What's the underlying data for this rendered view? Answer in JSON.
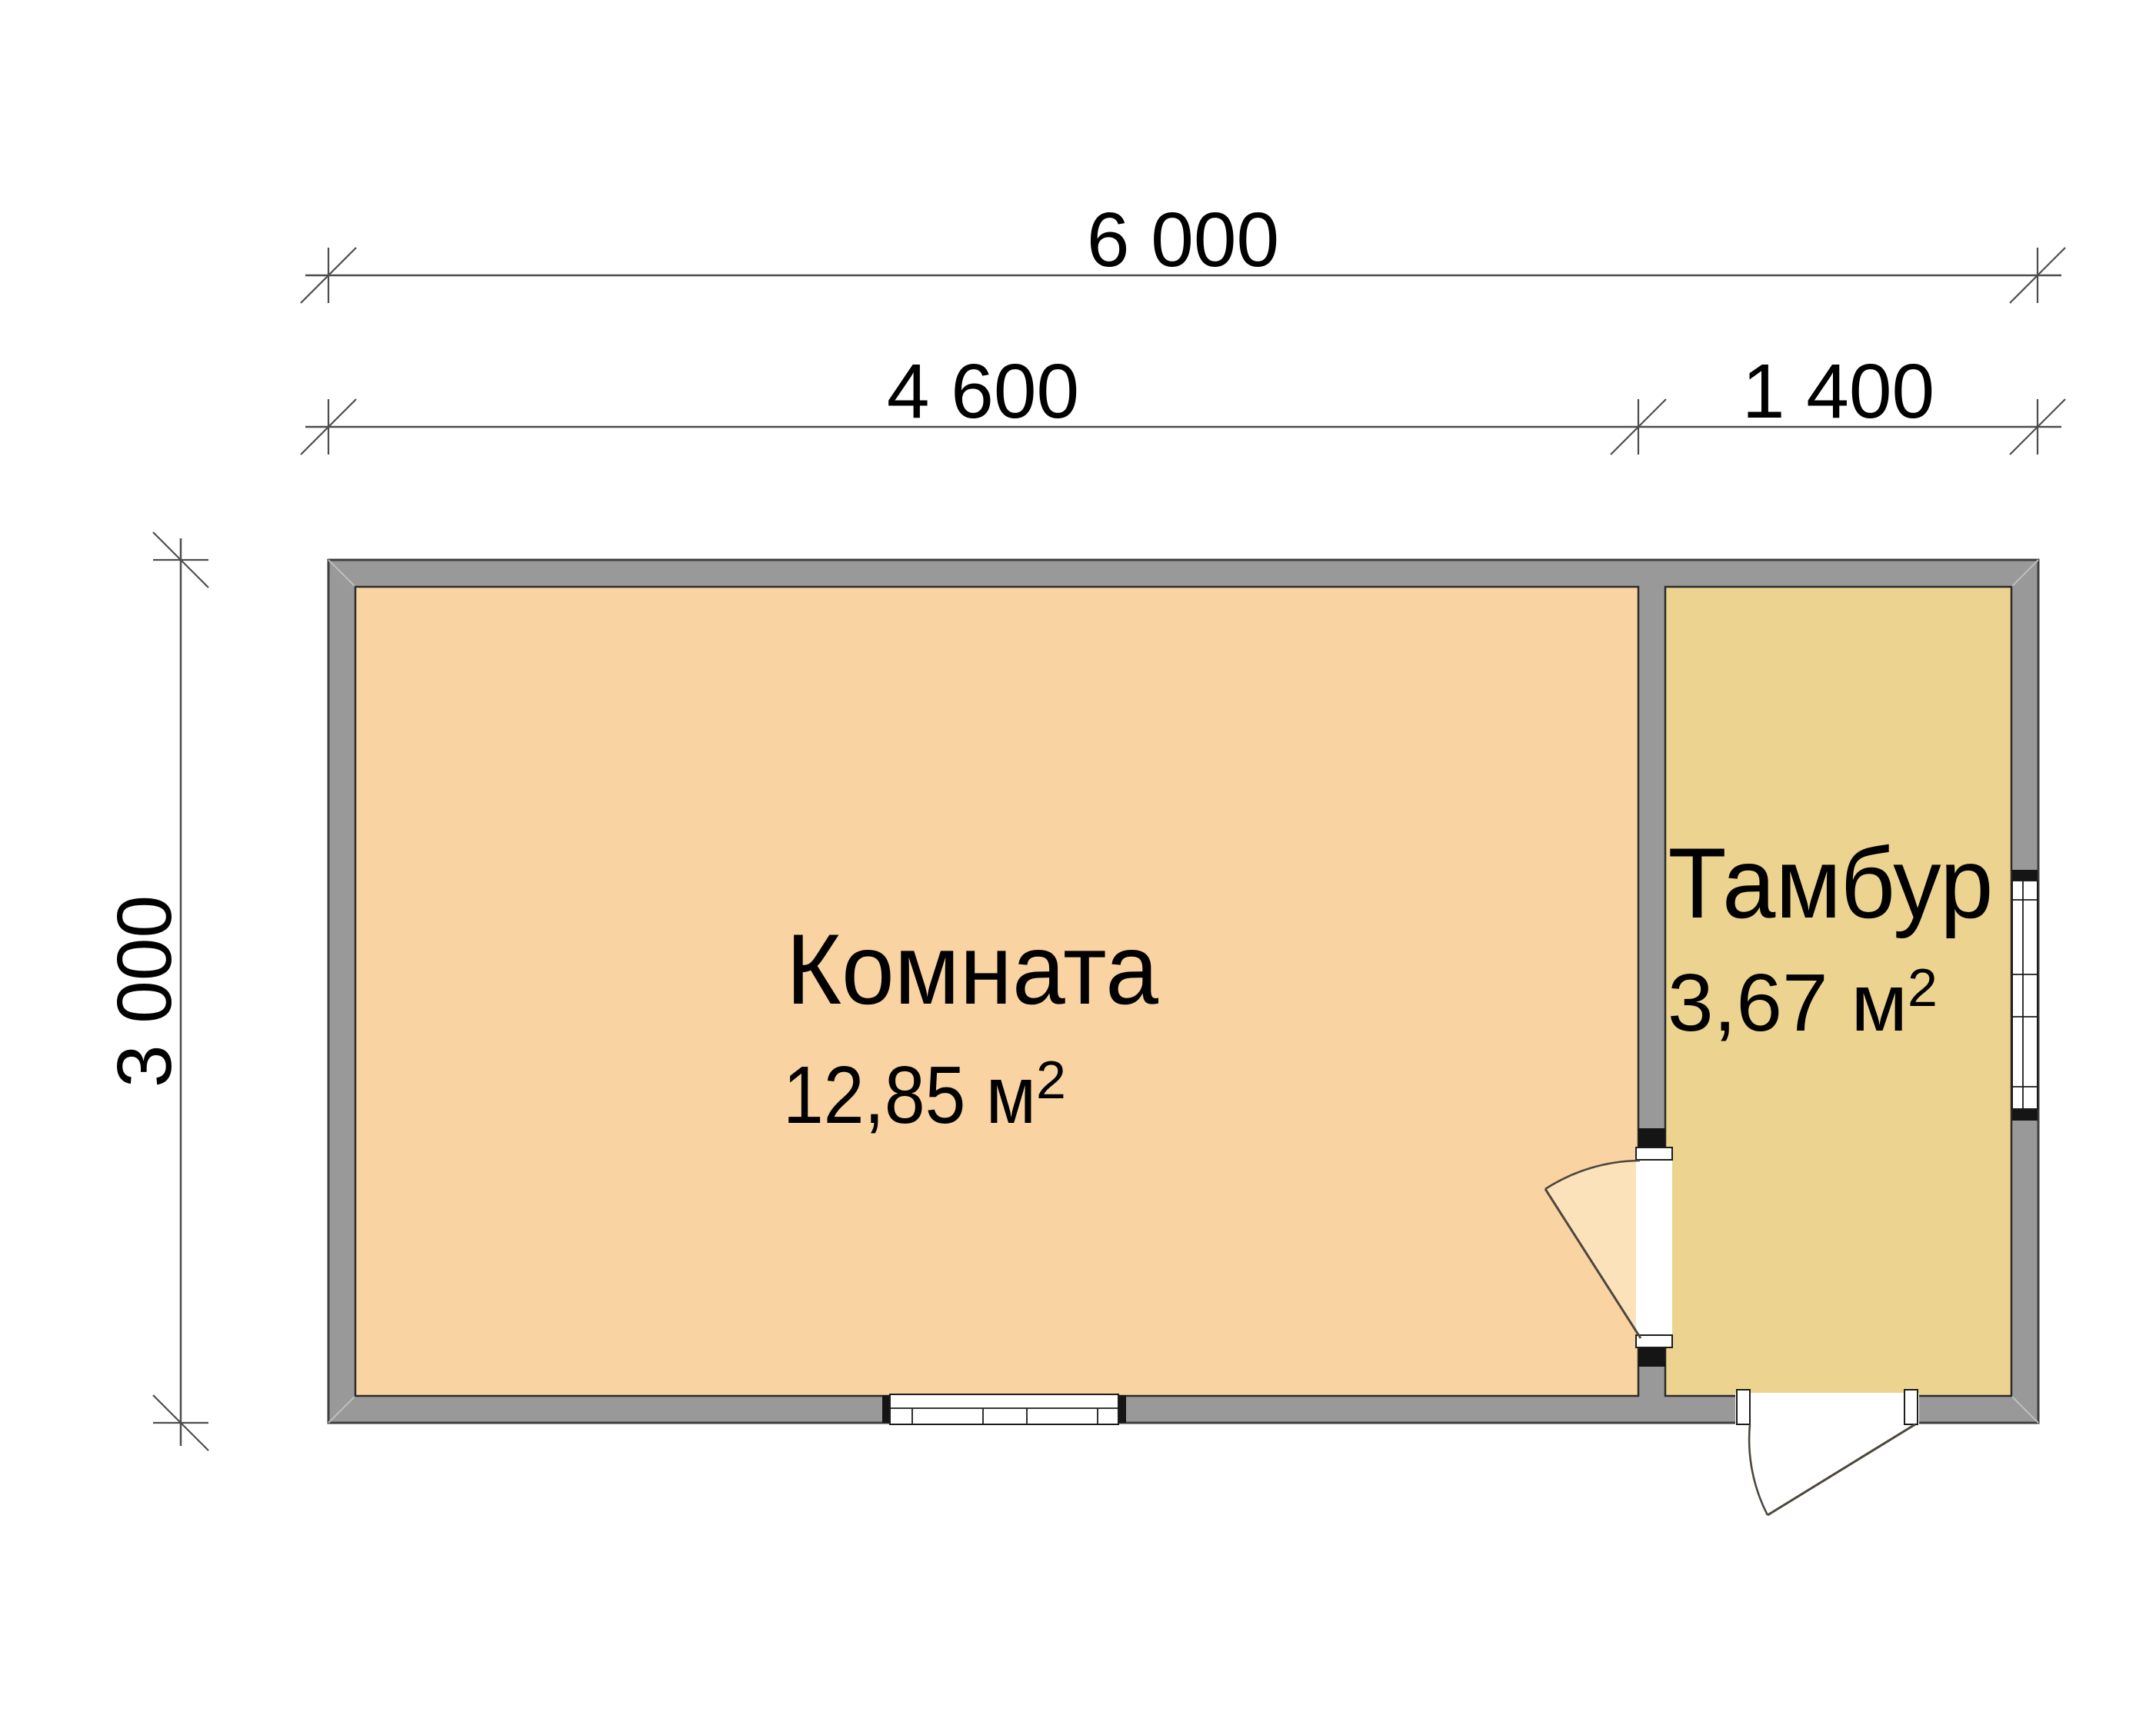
{
  "drawing": {
    "dimensions": {
      "total_width": "6 000",
      "room_width": "4 600",
      "vestibule_width": "1 400",
      "height": "3 000"
    },
    "rooms": [
      {
        "name": "Комната",
        "area": "12,85 м",
        "area_sup": "2"
      },
      {
        "name": "Тамбур",
        "area": "3,67 м",
        "area_sup": "2"
      }
    ],
    "colors": {
      "wall_fill": "#999999",
      "room_fill": "#f9d3a2",
      "vestibule_fill": "#ecd38f",
      "door_swing_fill": "#fbe2ba",
      "opening_fill": "#ffffff",
      "outline": "#3e3e3e",
      "dimension_line": "#4d4d4d",
      "text": "#000000"
    }
  }
}
